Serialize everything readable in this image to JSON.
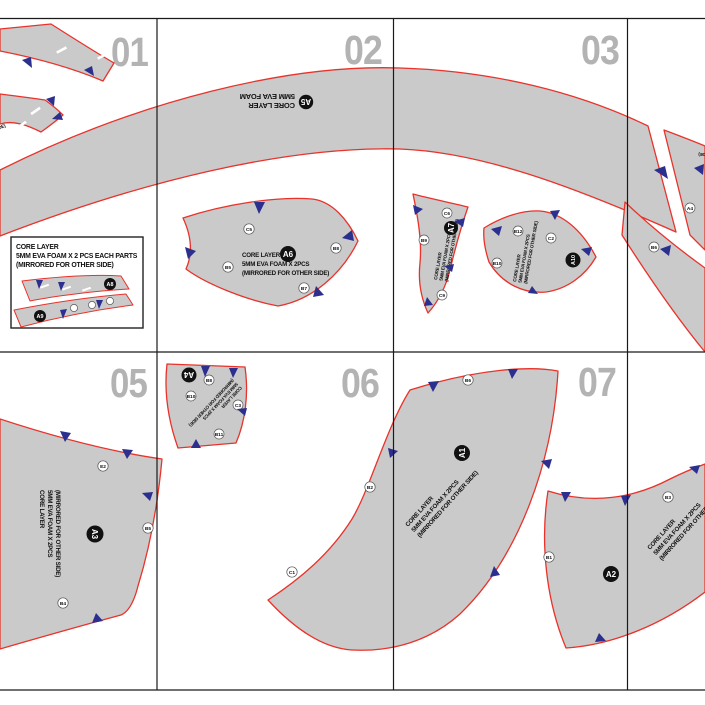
{
  "sheet": {
    "page_numbers": [
      "01",
      "02",
      "03",
      "05",
      "06",
      "07"
    ]
  },
  "standard_piece_label": {
    "line1": "CORE LAYER",
    "line2": "5MM EVA FOAM X 2PCS",
    "line3": "(MIRRORED FOR OTHER SIDE)"
  },
  "band_piece": {
    "badge": "A5",
    "label_line1": "CORE LAYER",
    "label_line2": "5MM EVA FOAM"
  },
  "legend_box": {
    "line1": "CORE LAYER",
    "line2": "5MM EVA FOAM X 2 PCS EACH PARTS",
    "line3": "(MIRRORED FOR OTHER SIDE)",
    "strip_badge_top": "A8",
    "strip_badge_bottom": "A9"
  },
  "pieces": {
    "a6": {
      "badge": "A6",
      "notches": [
        "C5",
        "B8",
        "B5",
        "B7"
      ]
    },
    "a7": {
      "badge": "A7",
      "notches": [
        "C6",
        "B9",
        "C9"
      ]
    },
    "a10": {
      "badge": "A10",
      "notches": [
        "B12",
        "C2",
        "B10"
      ]
    },
    "a4": {
      "badge": "A4",
      "notches": [
        "B8",
        "B10",
        "C3",
        "B11"
      ]
    },
    "a3": {
      "badge": "A3",
      "notches": [
        "E2",
        "B5",
        "B4"
      ]
    },
    "a1": {
      "badge": "A1",
      "notches": [
        "B6",
        "B2",
        "C1"
      ]
    },
    "a2": {
      "badge": "A2",
      "notches": [
        "B3",
        "B1"
      ]
    },
    "edge_top": {
      "notches": [
        "A4"
      ]
    },
    "edge_bottom": {
      "notches": [
        "B6"
      ]
    }
  },
  "colors": {
    "piece_fill": "#cacaca",
    "cut_line_red": "#e8332b",
    "notch_blue": "#2b2f8e",
    "page_number_gray": "#b3b3b3",
    "grid_line_black": "#1a1a1a"
  }
}
